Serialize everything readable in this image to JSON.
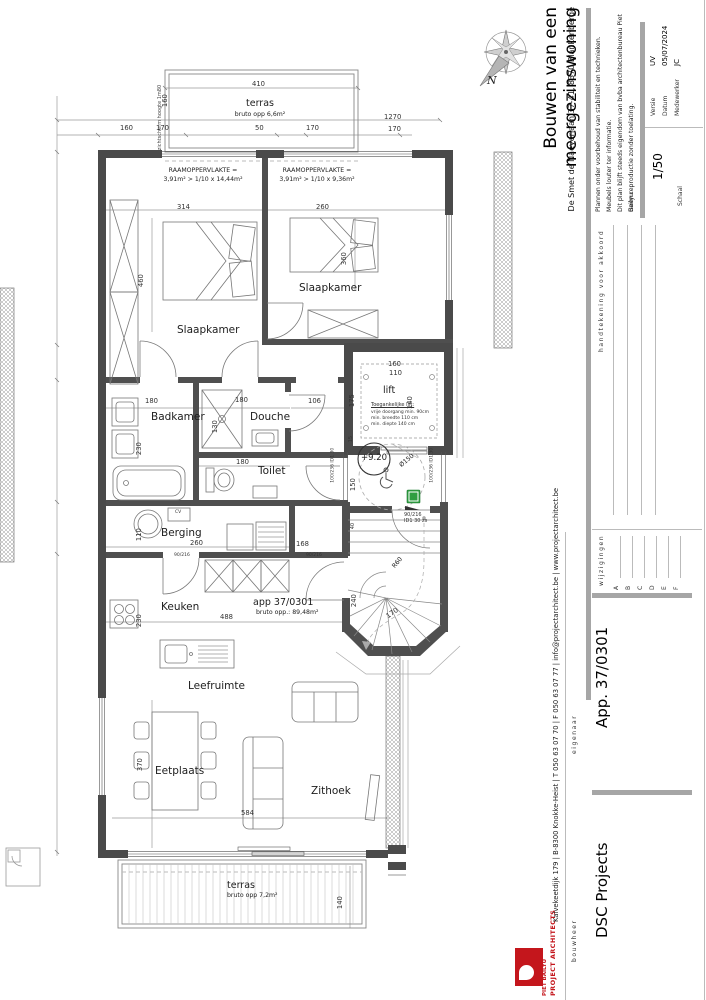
{
  "colors": {
    "wall": "#4a4a4a",
    "bar": "#a6a6a6",
    "accent_red": "#c4161c",
    "green": "#2f9e41"
  },
  "compass": {
    "north_label": "N"
  },
  "title_block": {
    "brand_line1": "PIET BAILYU",
    "brand_line2": "PROJECT ARCHITECTS",
    "contact": "Kalvekeetdijk 179   |   B-8300 Knokke-Heist   |   T 050 63 07 70   |   F 050 63 07 77   |   info@projectarchitect.be   |   www.projectarchitect.be",
    "title": "Bouwen van een meergezinswoning",
    "address": "De Smet de Naeyerlaan 37-41, 8370 Blankenberge",
    "notes": [
      "Plannen onder voorbehoud van stabiliteit en technieken.",
      "Meubels louter ter informatie.",
      "Dit plan blijft steeds eigendom van bvba architectenbureau Piet Bailyu.",
      "Geen reproductie zonder toelating."
    ],
    "bouwheer_label": "bouwheer",
    "bouwheer_value": "DSC Projects",
    "eigenaar_label": "eigenaar",
    "eigenaar_value": "App. 37/0301",
    "wijzigingen_label": "wijzigingen",
    "revisions": [
      "A",
      "B",
      "C",
      "D",
      "E",
      "F"
    ],
    "handtekening_label": "handtekening voor akkoord",
    "schaal_label": "Schaal",
    "schaal_value": "1/50",
    "versie_label": "Versie",
    "versie_value": "UV",
    "datum_label": "Datum",
    "datum_value": "05/07/2024",
    "medewerker_label": "Medewerker",
    "medewerker_value": "JC"
  },
  "rooms": {
    "slaapkamer1": "Slaapkamer",
    "slaapkamer2": "Slaapkamer",
    "badkamer": "Badkamer",
    "douche": "Douche",
    "toilet": "Toilet",
    "berging": "Berging",
    "keuken": "Keuken",
    "leefruimte": "Leefruimte",
    "eetplaats": "Eetplaats",
    "zithoek": "Zithoek",
    "lift": "lift"
  },
  "terras_top": {
    "name": "terras",
    "area": "bruto opp 6,6m²"
  },
  "terras_bottom": {
    "name": "terras",
    "area": "bruto opp 7,2m²"
  },
  "apartment": {
    "name": "app 37/0301",
    "area": "bruto opp.: 89,48m²"
  },
  "lift_spec": {
    "title": "Toegankelijke lift:",
    "lines": [
      "vrije doorgang min. 90cm",
      "min. breedte 110 cm",
      "min. diepte 140 cm"
    ]
  },
  "level_marker": "+9.20",
  "window_notes": {
    "header": "RAAMOPPERVLAKTE =",
    "left": "3,91m² > 1/10 x 14,44m²",
    "right": "3,91m² > 1/10 x 9,36m²"
  },
  "screen_note": "zichtscherm hoogte 1m80",
  "cv_label": "CV",
  "door_labels": {
    "entrance_line1": "90/216",
    "entrance_line2": "ID1 30 zs",
    "corridor_left": "100/236 ID1 30",
    "corridor_right": "100/236 ID1 30",
    "kitchen": "90/216",
    "berging": "90/216"
  },
  "dims": {
    "top_width": "410",
    "terras_top_depth": "160",
    "row_160": "160",
    "row_170a": "170",
    "row_50": "50",
    "row_170b": "170",
    "total_width": "1270",
    "row_170r": "170",
    "bed1_w": "314",
    "bed1_d": "460",
    "bed2_w": "260",
    "bed2_d": "360",
    "lift_w_out": "160",
    "lift_w": "110",
    "lift_d1": "175",
    "lift_d": "140",
    "wall_15": "15",
    "circle_150": "150",
    "circle_dia": "Ø150",
    "wall_40": "40",
    "bad_w": "180",
    "bad_d": "230",
    "douche_w": "180",
    "douche_d": "130",
    "nook": "106",
    "toilet_w": "180",
    "berging_circle": "110",
    "berging_w": "260",
    "keuken_d": "230",
    "keuken_w": "488",
    "kast": "168",
    "stair_w": "240",
    "stair_r": "R60",
    "stair_170": "170",
    "eet_d": "370",
    "leef_w": "584",
    "terras_b_d": "140"
  }
}
